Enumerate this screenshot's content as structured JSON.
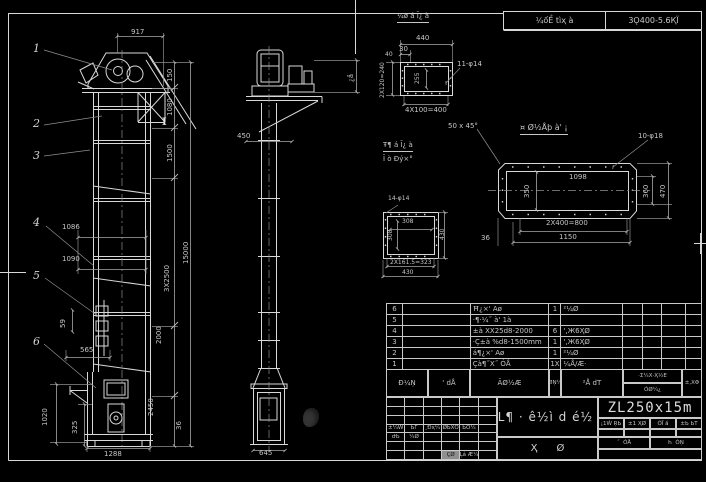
{
  "colors": {
    "background": "#000000",
    "line": "#d8d8d8",
    "dim_text": "#c6c6c6"
  },
  "header_bar": {
    "left": "¼ốỀ tìҳ à",
    "right": "3Ǫ400-5.6ҚЇ"
  },
  "bom": {
    "header": {
      "c1": "Đ¼Ņ",
      "c2": "' dÅ",
      "c3": "ÃØ½Æ",
      "c4": "ØŅ¼",
      "c5": "²Å dT",
      "c6a": "·Σ¼X·Ҳ½E",
      "c6b": "ÓØ¼¿",
      "c7": "±,XΦ"
    },
    "rows": [
      {
        "seq": "6",
        "code": "",
        "name": "Ħ¿×' Aø",
        "qty": "1",
        "material": "²¼Ø"
      },
      {
        "seq": "5",
        "code": "",
        "name": "·¶·¼˝ à' 1à",
        "qty": "",
        "material": ""
      },
      {
        "seq": "4",
        "code": "",
        "name": "±à XX25d8-2000",
        "qty": "6",
        "material": "',Ж6ҲØ"
      },
      {
        "seq": "3",
        "code": "",
        "name": "·Ç±à %d8-1500mm",
        "qty": "1",
        "material": "',Ж6ҲØ"
      },
      {
        "seq": "2",
        "code": "",
        "name": "á¶¿×' Aø",
        "qty": "1",
        "material": "²¼Ø"
      },
      {
        "seq": "1",
        "code": "",
        "name": "Çà¶˝X˝ ÓÅ",
        "qty": "1X",
        "material": "¼Å/Æ·"
      }
    ]
  },
  "title_block": {
    "title": "ZL¶ · ê½ì d é½ ù",
    "model": "ZL250x15m",
    "bottom_title": "Ҳ      Ø",
    "params": {
      "p1": "¡1Ẃ ŖЬ",
      "p2": "±1 ҲØ",
      "p3": "ÓЇ ầ",
      "p4": "±Ь ЬТ",
      "r2a": "˝  ÓÅ",
      "r2b": "Һ  ÓŅ"
    },
    "left_grid": {
      "cells": {
        "18": "±¼Ẃ",
        "19": "ЬΓ",
        "20": "¸Đҳ¼",
        "21": "ØЬXŌ",
        "22": "ЬÓ¼",
        "24": "ԺЬ",
        "25": "¼Ø",
        "39": "ÇØ",
        "40": "Ļả Æ¼"
      },
      "gray": "39"
    }
  },
  "annotations": [
    {
      "id": "dim-917",
      "t": "917",
      "x": 131,
      "y": 29
    },
    {
      "id": "dim-150",
      "t": "150",
      "x": 167,
      "y": 82,
      "r": 1
    },
    {
      "id": "dim-1080",
      "t": "1080",
      "x": 167,
      "y": 116,
      "r": 1
    },
    {
      "id": "dim-1500",
      "t": "1500",
      "x": 167,
      "y": 162,
      "r": 1
    },
    {
      "id": "dim-3x2500",
      "t": "3X2500",
      "x": 164,
      "y": 292,
      "r": 1
    },
    {
      "id": "dim-2000",
      "t": "2000",
      "x": 156,
      "y": 344,
      "r": 1
    },
    {
      "id": "dim-15000",
      "t": "15000",
      "x": 183,
      "y": 264,
      "r": 1
    },
    {
      "id": "dim-2450",
      "t": "2450",
      "x": 148,
      "y": 416,
      "r": 1
    },
    {
      "id": "dim-36-left",
      "t": "36",
      "x": 176,
      "y": 430,
      "r": 1
    },
    {
      "id": "dim-1086",
      "t": "1086",
      "x": 62,
      "y": 224
    },
    {
      "id": "dim-1090",
      "t": "1090",
      "x": 62,
      "y": 256
    },
    {
      "id": "dim-59",
      "t": "59",
      "x": 60,
      "y": 328,
      "r": 1
    },
    {
      "id": "dim-565",
      "t": "565",
      "x": 80,
      "y": 347
    },
    {
      "id": "dim-1020",
      "t": "1020",
      "x": 42,
      "y": 426,
      "r": 1
    },
    {
      "id": "dim-325",
      "t": "325",
      "x": 72,
      "y": 434,
      "r": 1
    },
    {
      "id": "dim-1288",
      "t": "1288",
      "x": 104,
      "y": 451
    },
    {
      "id": "balloon-1",
      "t": "1",
      "x": 33,
      "y": 43,
      "c": "balloon"
    },
    {
      "id": "balloon-2",
      "t": "2",
      "x": 33,
      "y": 118,
      "c": "balloon"
    },
    {
      "id": "balloon-3",
      "t": "3",
      "x": 33,
      "y": 150,
      "c": "balloon"
    },
    {
      "id": "balloon-4",
      "t": "4",
      "x": 33,
      "y": 217,
      "c": "balloon"
    },
    {
      "id": "balloon-5",
      "t": "5",
      "x": 33,
      "y": 270,
      "c": "balloon"
    },
    {
      "id": "balloon-6",
      "t": "6",
      "x": 33,
      "y": 336,
      "c": "balloon"
    },
    {
      "id": "section-mark-i",
      "t": "I",
      "x": 162,
      "y": 117,
      "c": "imark"
    },
    {
      "id": "dim-450",
      "t": "450",
      "x": 237,
      "y": 133
    },
    {
      "id": "dim-645",
      "t": "645",
      "x": 259,
      "y": 450
    },
    {
      "id": "dim-side-vert",
      "t": "¿ầ",
      "x": 348,
      "y": 82,
      "r": 1
    },
    {
      "id": "detail1-title",
      "t": "¼ø á Ī¿ à",
      "x": 397,
      "y": 13,
      "u": 1
    },
    {
      "id": "dim-440",
      "t": "440",
      "x": 416,
      "y": 35
    },
    {
      "id": "dim-30",
      "t": "30",
      "x": 399,
      "y": 46
    },
    {
      "id": "dim-40",
      "t": "40",
      "x": 385,
      "y": 52,
      "s": 6
    },
    {
      "id": "dim-2x120",
      "t": "2X120=240",
      "x": 380,
      "y": 98,
      "r": 1,
      "s": 6
    },
    {
      "id": "dim-255",
      "t": "255",
      "x": 415,
      "y": 84,
      "r": 1,
      "s": 6
    },
    {
      "id": "dim-4x100",
      "t": "4X100=400",
      "x": 405,
      "y": 107
    },
    {
      "id": "hole-11-14",
      "t": "11-φ14",
      "x": 457,
      "y": 61
    },
    {
      "id": "note-line1",
      "t": "Ŧ¶ á Ī¿ à",
      "x": 383,
      "y": 142,
      "u": 1
    },
    {
      "id": "note-line2",
      "t": "Ī ò Ðý×°",
      "x": 383,
      "y": 156
    },
    {
      "id": "hole-14-14",
      "t": "14-φ14",
      "x": 388,
      "y": 196,
      "s": 6
    },
    {
      "id": "dim-308a",
      "t": "308",
      "x": 402,
      "y": 219,
      "s": 6
    },
    {
      "id": "dim-308b",
      "t": "308",
      "x": 388,
      "y": 241,
      "r": 1,
      "s": 6
    },
    {
      "id": "dim-430a",
      "t": "430",
      "x": 440,
      "y": 240,
      "r": 1,
      "s": 6
    },
    {
      "id": "dim-2x161",
      "t": "2X161.5=323",
      "x": 390,
      "y": 260,
      "s": 6
    },
    {
      "id": "dim-430b",
      "t": "430",
      "x": 402,
      "y": 270,
      "s": 6
    },
    {
      "id": "detail4-title",
      "t": "¤ Ø½Åþ à' ¡",
      "x": 520,
      "y": 124,
      "s": 8,
      "u": 1
    },
    {
      "id": "note-chamfer",
      "t": "50 x 45°",
      "x": 448,
      "y": 123
    },
    {
      "id": "hole-10-18",
      "t": "10-φ18",
      "x": 638,
      "y": 133
    },
    {
      "id": "dim-1098",
      "t": "1098",
      "x": 569,
      "y": 174
    },
    {
      "id": "dim-350",
      "t": "350",
      "x": 524,
      "y": 198,
      "r": 1
    },
    {
      "id": "dim-360",
      "t": "360",
      "x": 643,
      "y": 198,
      "r": 1
    },
    {
      "id": "dim-470",
      "t": "470",
      "x": 660,
      "y": 198,
      "r": 1
    },
    {
      "id": "dim-2x400",
      "t": "2X400=800",
      "x": 546,
      "y": 220
    },
    {
      "id": "dim-1150",
      "t": "1150",
      "x": 559,
      "y": 234
    },
    {
      "id": "dim-36-right",
      "t": "36",
      "x": 481,
      "y": 235
    }
  ]
}
